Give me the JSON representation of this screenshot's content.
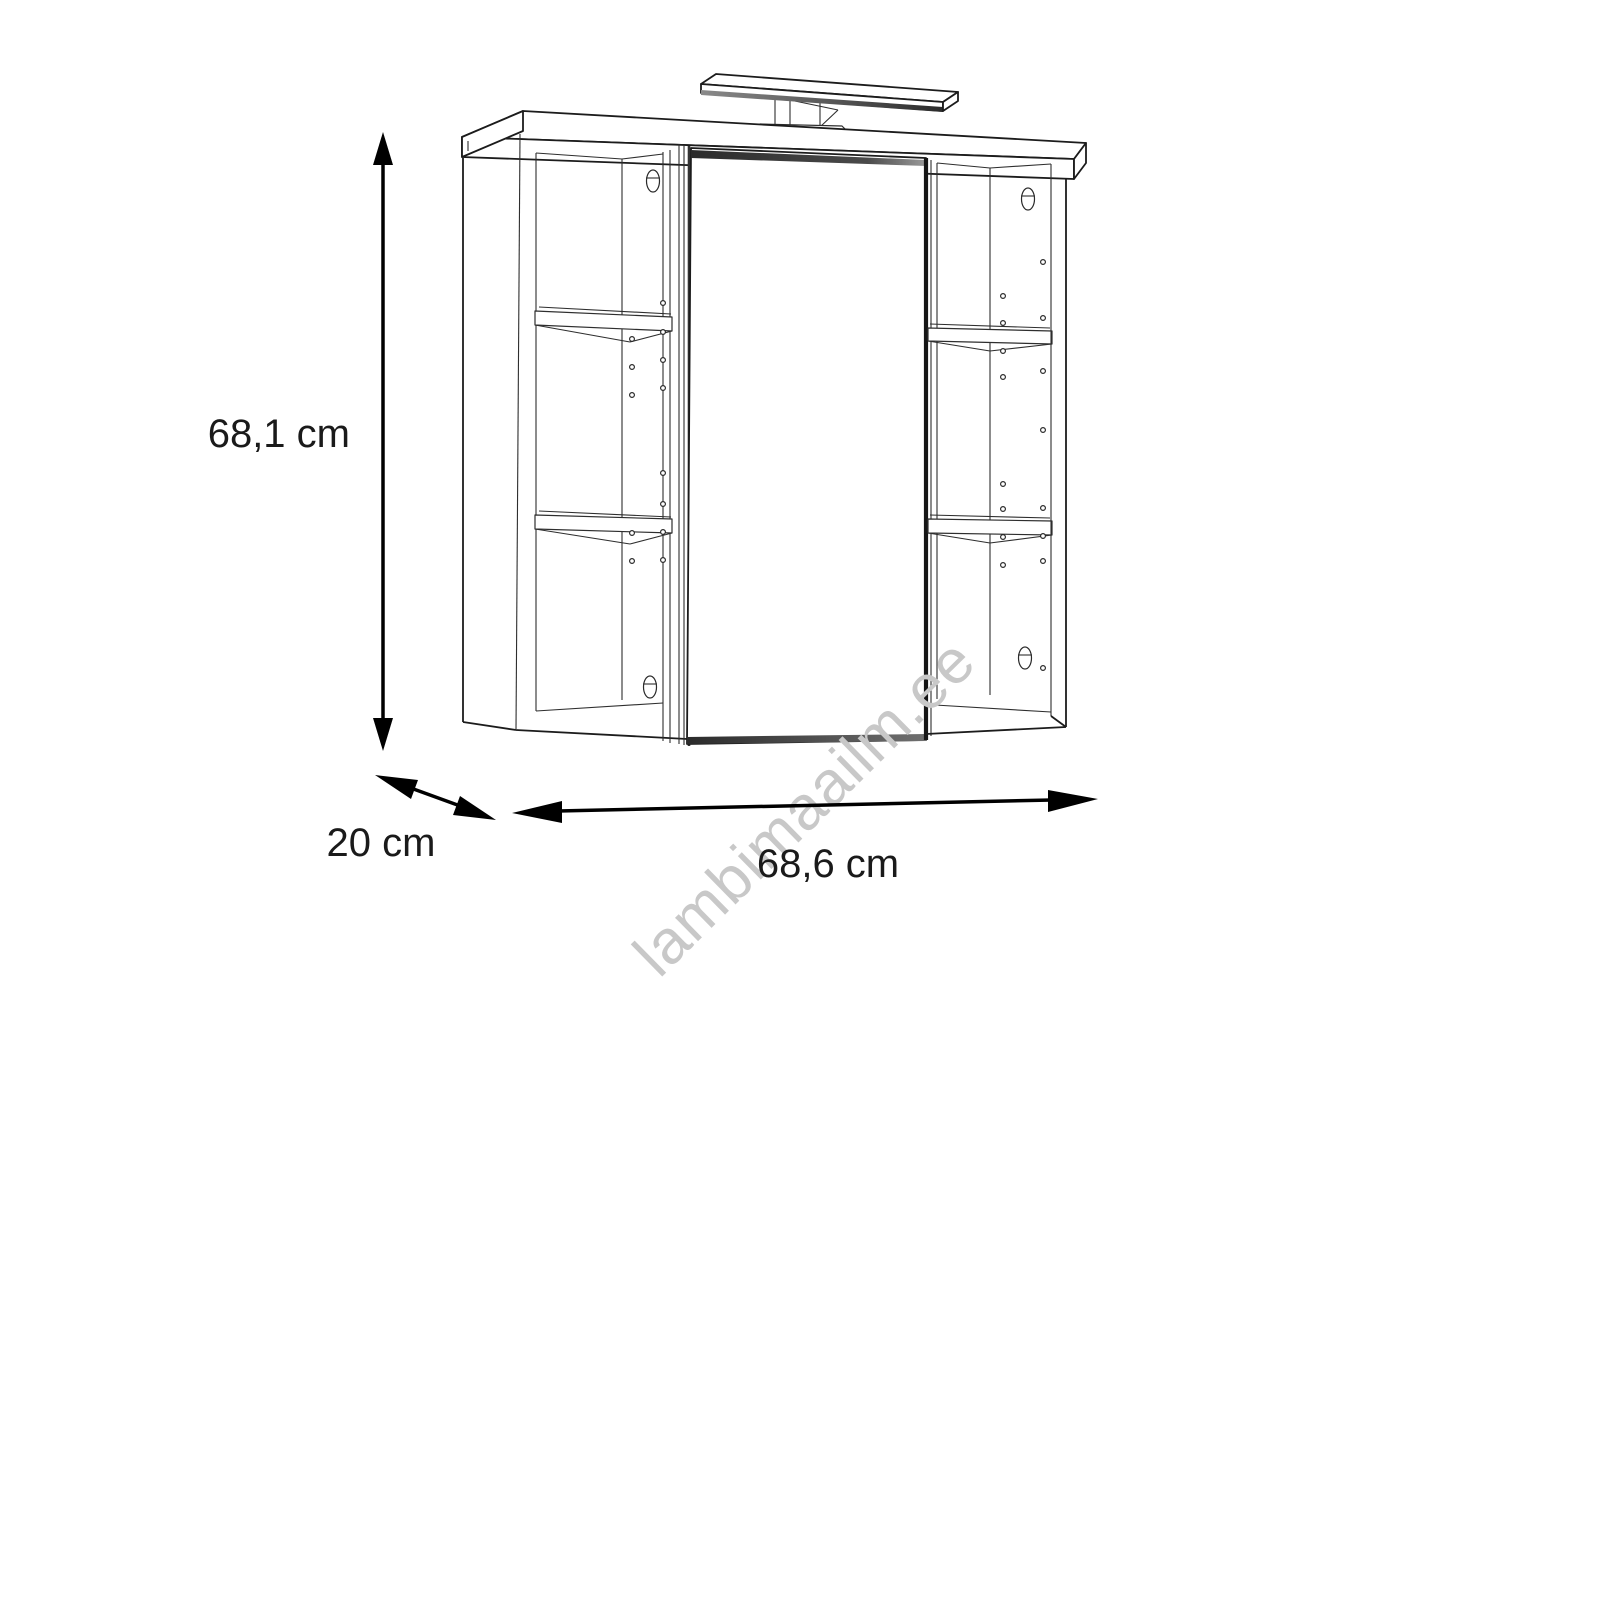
{
  "drawing": {
    "subject": "bathroom-mirror-cabinet-with-light",
    "line_color": "#1c1c1c",
    "background": "#ffffff"
  },
  "dimensions": {
    "height": {
      "label": "68,1 cm"
    },
    "depth": {
      "label": "20 cm"
    },
    "width": {
      "label": "68,6 cm"
    }
  },
  "watermark": {
    "text": "lambimaailm.ee",
    "color": "#c8c8c8"
  }
}
